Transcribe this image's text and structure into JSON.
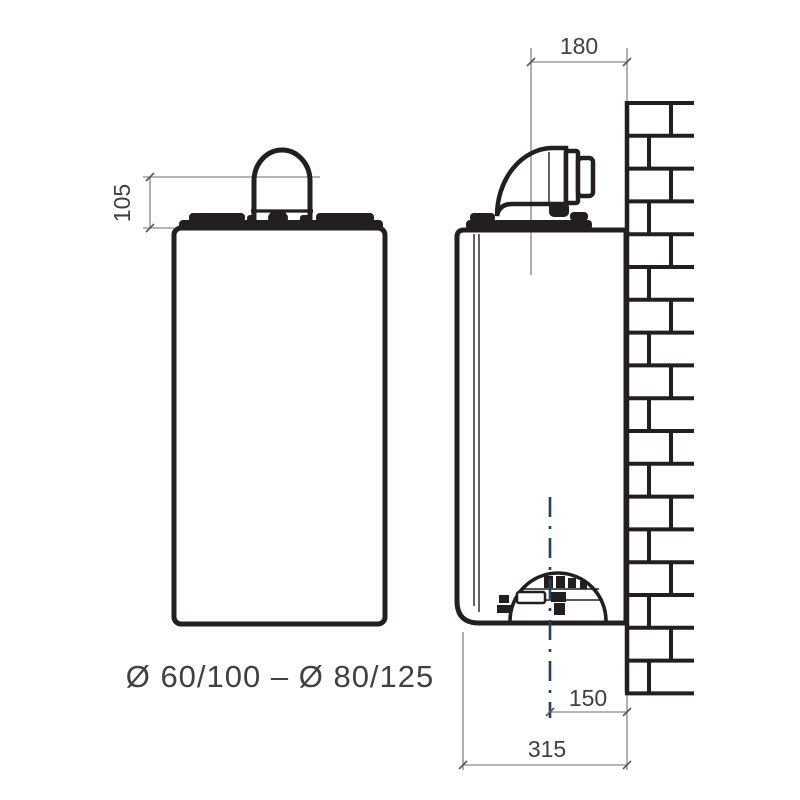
{
  "drawing": {
    "caption": "Ø 60/100 – Ø 80/125",
    "dimensions": {
      "flue_height_above_casing": "105",
      "wall_to_flue_axis": "180",
      "wall_to_bottom_centerline": "150",
      "overall_depth_from_wall": "315"
    },
    "colors": {
      "outline": "#231f20",
      "dimension_lines": "#6d6e71",
      "text": "#414042",
      "centerline": "#23425f",
      "background": "#ffffff"
    }
  }
}
